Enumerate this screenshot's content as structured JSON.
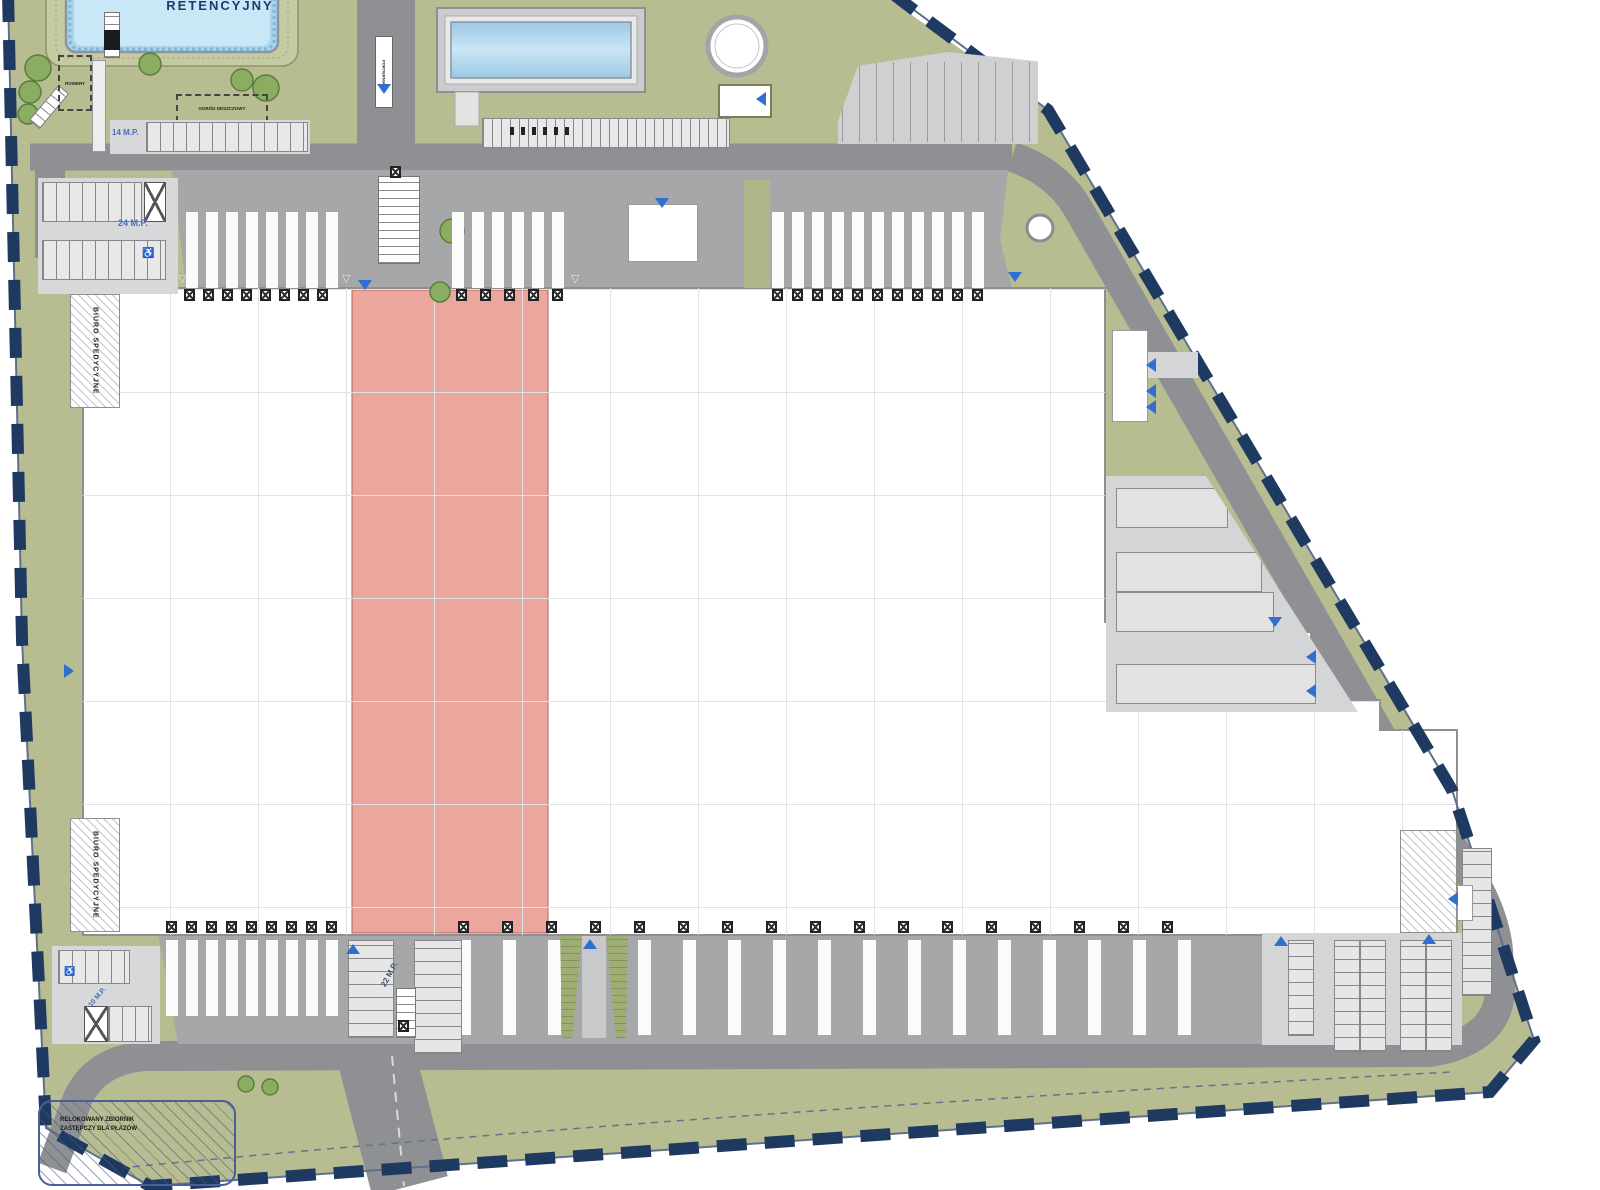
{
  "plan": {
    "labels": {
      "retention_pond": "RETENCYJNY",
      "rain_garden": "OGRÓD DESZCZOWY",
      "bike_shelter": "ROWERY",
      "gatehouse": "PORTIERNIA",
      "office": "BIURO SPEDYCYJNE",
      "amphibian_line1": "RELOKOWANY ZBIORNIK",
      "amphibian_line2": "ZASTĘPCZY DLA PŁAZÓW",
      "parking_14": "14 M.P.",
      "parking_24": "24 M.P.",
      "parking_10": "10 M.P.",
      "parking_22": "22 M.P.",
      "disabled_icon": "♿"
    },
    "colors": {
      "site_green": "#b7bd91",
      "road_gray": "#8f9093",
      "apron_gray": "#a6a7a9",
      "pavement_light": "#d4d5d6",
      "building_white": "#ffffff",
      "highlight_bay_red": "#eba79e",
      "water_blue": "#a9d4eb",
      "boundary_navy": "#1e3a60",
      "arrow_blue": "#2f6fd0",
      "label_blue": "#4a6fbe"
    }
  }
}
